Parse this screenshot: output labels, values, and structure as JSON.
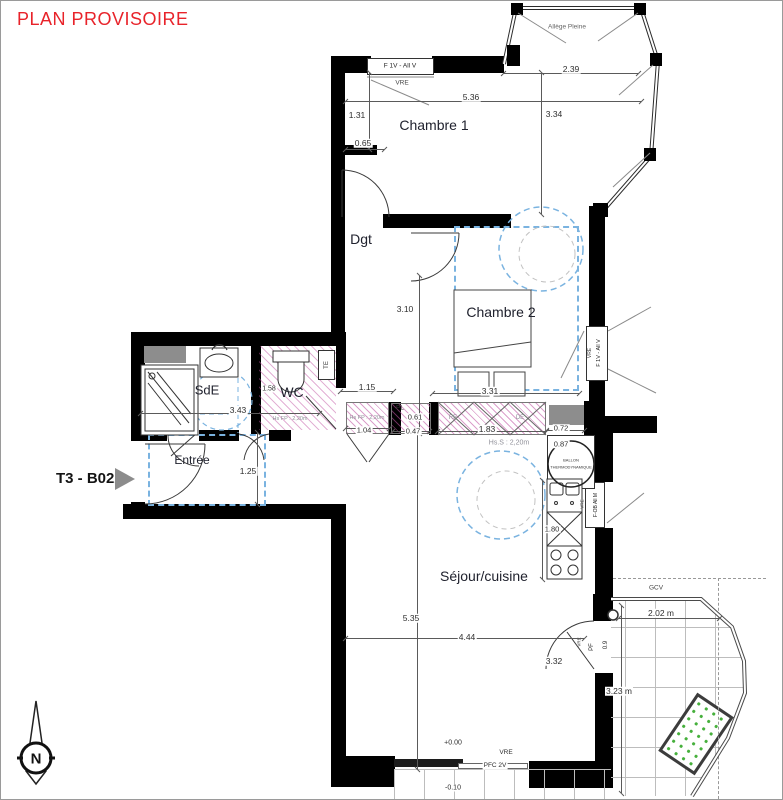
{
  "title": "PLAN PROVISOIRE",
  "unit_label": "T3 - B022",
  "compass_letter": "N",
  "rooms": {
    "chambre1": "Chambre 1",
    "dgt": "Dgt",
    "chambre2": "Chambre 2",
    "sde": "SdE",
    "wc": "WC",
    "entree": "Entrée",
    "sejour": "Séjour/cuisine"
  },
  "openings": {
    "c1_window": "F 1V - All V",
    "c1_window_type": "VRE",
    "c2_window": "F 1V - All V",
    "c2_window_type": "VRE",
    "kitchen_window": "F-OB All M",
    "kitchen_window_type": "VRE",
    "balcony_door": "PF",
    "balcony_door_width": "0.9",
    "balcony_door_type": "VRE",
    "sliding_door": "PFC 2V",
    "sliding_door_type": "VRE",
    "guardrail": "GCV",
    "bay_sill": "Allège Pleine"
  },
  "annotations": {
    "te": "TE",
    "pl": "PL",
    "re": "RE",
    "de": "DE",
    "hs_fp_wc": "Hs FP : 2,20m",
    "hs_fp_hall": "Hs FP : 2,20m",
    "hs_s": "Hs.S : 2,20m",
    "ballon_line1": "BALLON",
    "ballon_line2": "THERMODYNAMIQUE",
    "level_interior": "+0.00",
    "level_balcony": "-0.10"
  },
  "dimensions": {
    "bay_width": "2.39",
    "c1_width": "5.36",
    "c1_depth": "3.34",
    "c1_niche_depth": "1.31",
    "c1_niche_width": "0.65",
    "c2_depth": "3.10",
    "c2_width": "3.31",
    "hall_width": "1.15",
    "sde_width": "3.43",
    "wc_width": "1.58",
    "hall_strip": "1.04",
    "pl_width": "0.61",
    "pl_depth": "0.47",
    "kitchen_strip": "1.83",
    "duct_width": "0.72",
    "ballon_width": "0.87",
    "entree_width": "1.25",
    "sejour_depth": "5.35",
    "sejour_width": "4.44",
    "door_offset": "3.32",
    "kitchen_len": "1.80",
    "balcony_width": "2.02 m",
    "balcony_depth": "3.23 m"
  }
}
